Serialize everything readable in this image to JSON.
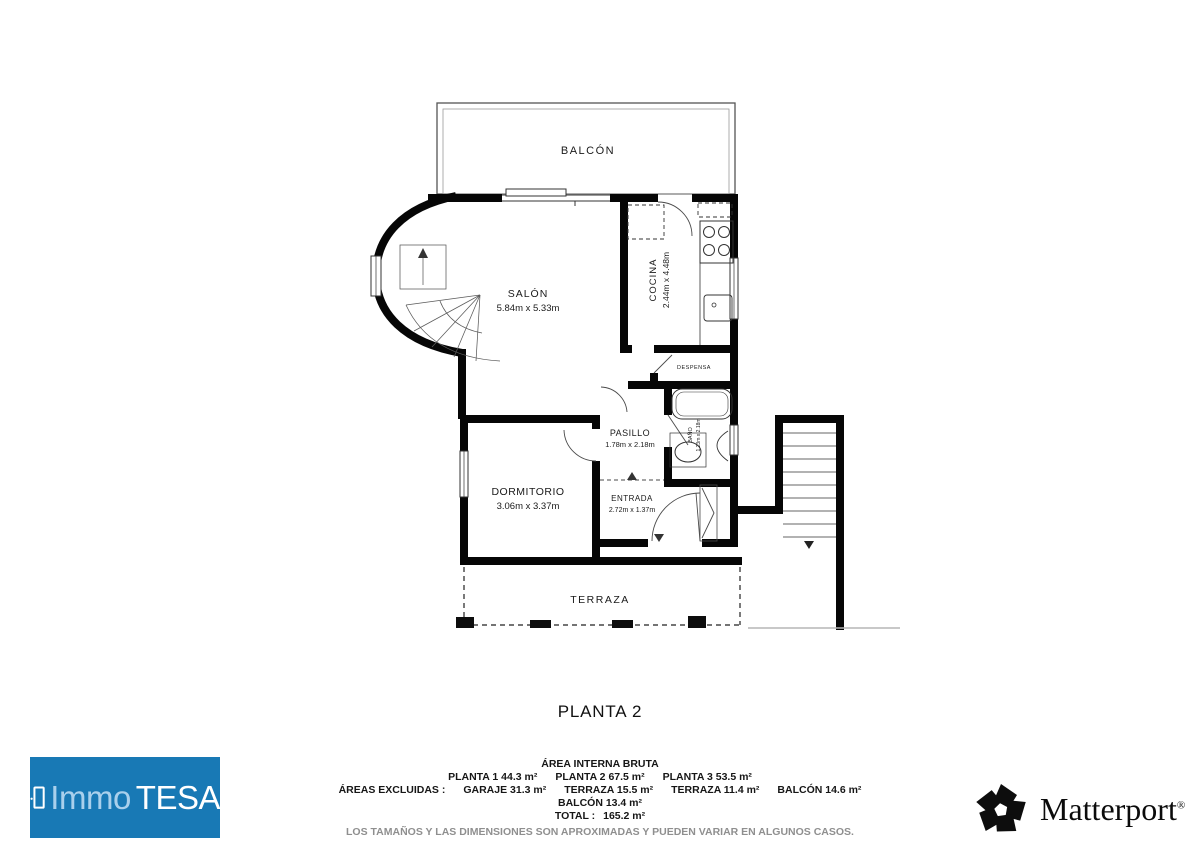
{
  "floor_title": "PLANTA 2",
  "rooms": {
    "balcon": {
      "label": "BALCÓN"
    },
    "salon": {
      "label": "SALÓN",
      "dims": "5.84m x 5.33m"
    },
    "cocina": {
      "label": "COCINA",
      "dims": "2.44m x 4.48m"
    },
    "despensa": {
      "label": "DESPENSA"
    },
    "pasillo": {
      "label": "PASILLO",
      "dims": "1.78m x 2.18m"
    },
    "bano": {
      "label": "BAÑO",
      "dims": "1.23m x 2.18m"
    },
    "dormitorio": {
      "label": "DORMITORIO",
      "dims": "3.06m x 3.37m"
    },
    "entrada": {
      "label": "ENTRADA",
      "dims": "2.72m x 1.37m"
    },
    "terraza": {
      "label": "TERRAZA"
    }
  },
  "summary": {
    "heading": "ÁREA INTERNA BRUTA",
    "plantas": [
      "PLANTA 1 44.3 m²",
      "PLANTA 2 67.5 m²",
      "PLANTA 3 53.5 m²"
    ],
    "excluded_label": "ÁREAS EXCLUIDAS :",
    "excluded": [
      "GARAJE 31.3 m²",
      "TERRAZA 15.5 m²",
      "TERRAZA 11.4 m²",
      "BALCÓN 14.6 m²"
    ],
    "balcon_line": "BALCÓN 13.4 m²",
    "total_label": "TOTAL :",
    "total_value": "165.2 m²",
    "disclaimer": "LOS TAMAÑOS Y LAS DIMENSIONES SON APROXIMADAS Y PUEDEN VARIAR EN ALGUNOS CASOS."
  },
  "branding": {
    "immotesa_immo": "Immo",
    "immotesa_tesa": "TESA",
    "immotesa_bg": "#1879b5",
    "immotesa_immo_color": "#a9d0ec",
    "immotesa_tesa_color": "#ffffff",
    "matterport_label": "Matterport",
    "matterport_reg": "®",
    "matterport_color": "#0b0b0b"
  }
}
